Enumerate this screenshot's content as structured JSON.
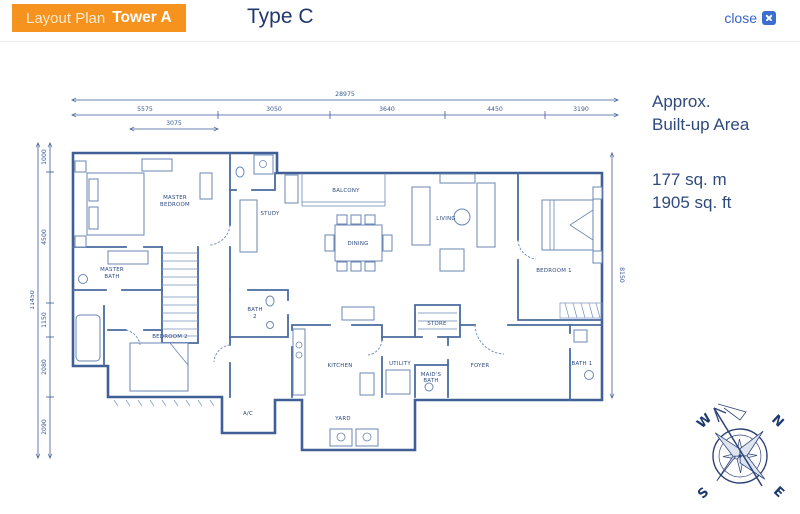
{
  "header": {
    "layout_plan_label": "Layout Plan",
    "tower_label": "Tower A",
    "type_label": "Type C",
    "close_label": "close"
  },
  "info": {
    "approx_line1": "Approx.",
    "approx_line2": "Built-up Area",
    "area_metric": "177 sq. m",
    "area_imperial": "1905 sq. ft"
  },
  "plan": {
    "rooms": {
      "master_bedroom": [
        "MASTER",
        "BEDROOM"
      ],
      "master_bath": [
        "MASTER",
        "BATH"
      ],
      "study": "STUDY",
      "balcony": "BALCONY",
      "dining": "DINING",
      "living": "LIVING",
      "bedroom1": "BEDROOM 1",
      "bedroom2": "BEDROOM 2",
      "bath1": "BATH 1",
      "bath2": [
        "BATH",
        "2"
      ],
      "kitchen": "KITCHEN",
      "utility": "UTILITY",
      "maids_bath": [
        "MAID'S",
        "BATH"
      ],
      "store": "STORE",
      "foyer": "FOYER",
      "yard": "YARD",
      "ac": "A/C"
    },
    "dimensions": {
      "top_overall": "28975",
      "top_segments": [
        "5575",
        "3050",
        "3640",
        "4450",
        "3190"
      ],
      "top_sub": "3075",
      "left_overall": "11450",
      "left_segments": [
        "1000",
        "4500",
        "1150",
        "2080",
        "2090"
      ],
      "right_overall": "8150"
    }
  },
  "compass": {
    "n": "N",
    "s": "S",
    "e": "E",
    "w": "W"
  },
  "colors": {
    "accent_orange": "#F6921E",
    "navy_text": "#21386E",
    "link_blue": "#3A66C8",
    "plan_line": "#4A6B9F"
  }
}
